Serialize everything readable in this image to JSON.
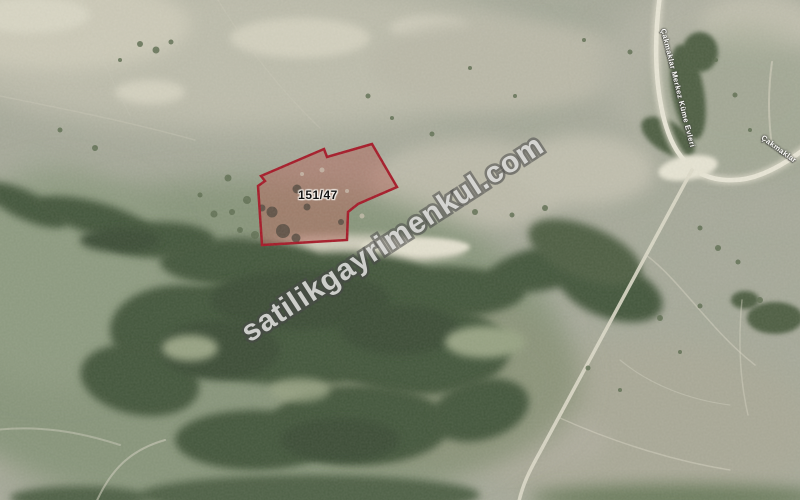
{
  "map": {
    "parcel": {
      "label": "151/47",
      "border_color": "#a51726",
      "fill_color": "#b4635a"
    },
    "watermark": {
      "text": "satilikgayrimenkul.com",
      "fill_color": "#ebebE9",
      "outline_color": "#484848"
    },
    "road_labels": [
      {
        "text": "Çakmaklar Merkez Küme Evleri"
      },
      {
        "text": "Çakmaklar"
      }
    ],
    "terrain_colors": {
      "field_base": "#a8a99b",
      "field_light": "#c9c6b6",
      "scrub_green": "#87947a",
      "forest_dark": "#43543b",
      "road_white": "#e8e5d6"
    }
  }
}
